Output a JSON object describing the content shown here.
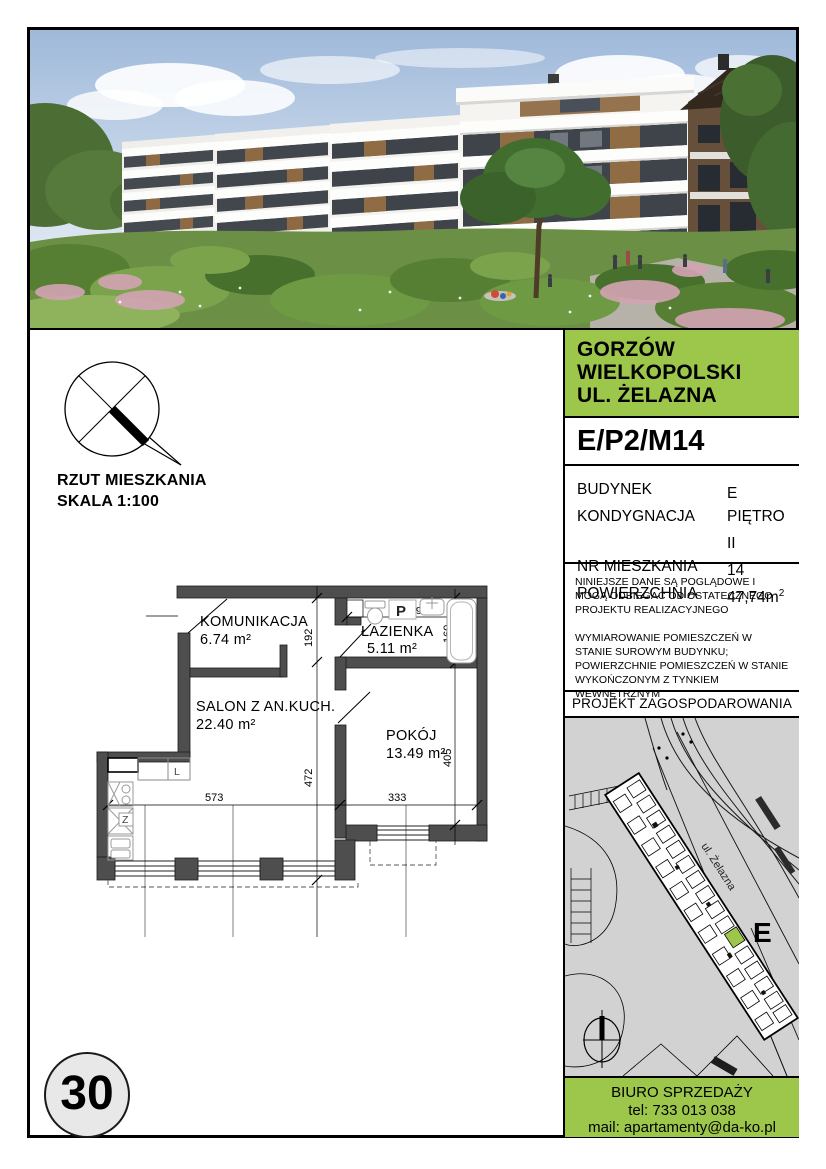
{
  "page": {
    "number": "30"
  },
  "plan_note": {
    "line1": "RZUT MIESZKANIA",
    "line2": "SKALA 1:100"
  },
  "floor_plan": {
    "rooms": [
      {
        "name": "KOMUNIKACJA",
        "area": "6.74 m²"
      },
      {
        "name": "ŁAZIENKA",
        "area": "5.11 m²"
      },
      {
        "name": "SALON Z AN.KUCH.",
        "area": "22.40 m²"
      },
      {
        "name": "POKÓJ",
        "area": "13.49 m²"
      }
    ],
    "dims": {
      "entry": "192",
      "bath_width": "294",
      "bath_height": "160",
      "room_height": "405",
      "salon_height": "472",
      "salon_width": "573",
      "room_width": "333"
    },
    "markers": {
      "washer": "P",
      "fridge": "L",
      "sink": "Z"
    }
  },
  "panel": {
    "location": {
      "line1": "GORZÓW",
      "line2": "WIELKOPOLSKI",
      "line3": "UL. ŻELAZNA"
    },
    "unit_code": "E/P2/M14",
    "details": {
      "rows": [
        {
          "label": "BUDYNEK",
          "value": "E",
          "sup": ""
        },
        {
          "label": "KONDYGNACJA",
          "value": "PIĘTRO II",
          "sup": ""
        },
        {
          "label": "NR MIESZKANIA",
          "value": "14",
          "sup": ""
        },
        {
          "label": "POWIERZCHNIA",
          "value": "47,74m",
          "sup": "2"
        }
      ]
    },
    "disclaimer": {
      "para1": "NINIEJSZE DANE SĄ POGLĄDOWE I MOGĄ ODBIEGAĆ OD OSTATECZNEGO PROJEKTU REALIZACYJNEGO",
      "para2": "WYMIAROWANIE POMIESZCZEŃ W STANIE SUROWYM BUDYNKU; POWIERZCHNIE POMIESZCZEŃ W STANIE WYKOŃCZONYM Z TYNKIEM WEWNĘTRZNYM"
    },
    "site_plan": {
      "title": "PROJEKT ZAGOSPODAROWANIA TERENU",
      "street": "ul. Żelazna",
      "building": "E"
    },
    "contact": {
      "line1": "BIURO SPRZEDAŻY",
      "line2": "tel: 733 013 038",
      "line3": "mail: apartamenty@da-ko.pl"
    }
  },
  "colors": {
    "accent_green": "#9CC74B",
    "wall_gray": "#4E4E4E"
  }
}
